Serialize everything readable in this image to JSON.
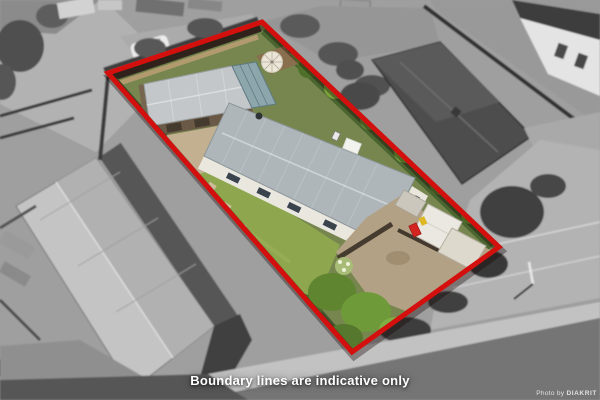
{
  "photo": {
    "caption": "Boundary lines are indicative only",
    "watermark": {
      "prefix": "Photo by ",
      "brand": "DIAKRIT"
    }
  },
  "boundary": {
    "color": "#d3100d",
    "shadow_color": "rgba(20,0,0,0.35)",
    "points": "108,73 262,22 499,247 352,352",
    "stroke_width": "5"
  }
}
